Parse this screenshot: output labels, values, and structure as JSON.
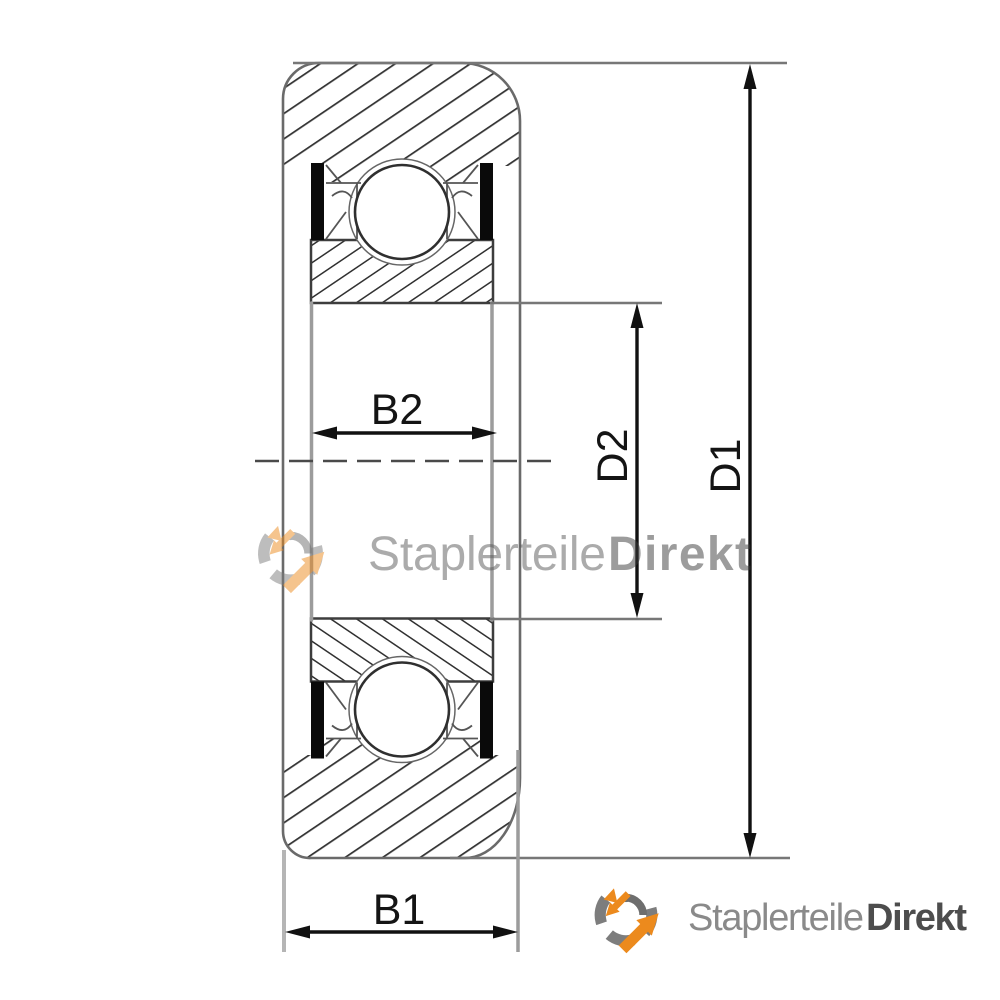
{
  "drawing": {
    "type": "bearing cross-section technical drawing",
    "dimension_labels": {
      "b1": "B1",
      "b2": "B2",
      "d1": "D1",
      "d2": "D2"
    }
  },
  "watermark": {
    "icon": "gear-arrows-icon",
    "brand_regular": "Staplerteile",
    "brand_bold": "Direkt"
  },
  "footer_logo": {
    "icon": "gear-arrows-icon",
    "brand_regular": "Staplerteile",
    "brand_bold": "Direkt"
  },
  "colors": {
    "accent_orange": "#EC8A1D",
    "logo_gray": "#8A8A8A",
    "logo_dark_gray": "#4D4D4D",
    "hatch_line": "#333333",
    "outline_gray": "#6A6A6A",
    "dimension_line": "#111111"
  }
}
